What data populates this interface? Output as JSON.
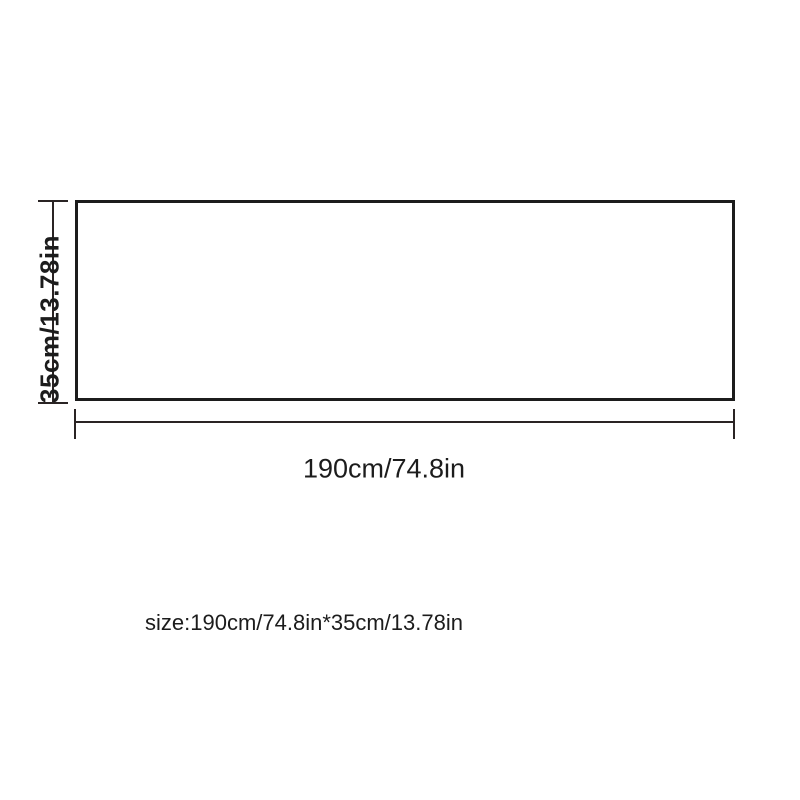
{
  "diagram": {
    "height_label": "35cm/13.78in",
    "width_label": "190cm/74.8in",
    "size_caption": "size:190cm/74.8in*35cm/13.78in",
    "dimensions": {
      "width_cm": 190,
      "width_in": 74.8,
      "height_cm": 35,
      "height_in": 13.78
    },
    "colors": {
      "background": "#ffffff",
      "outline": "#1c1c1c",
      "dimension_line": "#2a2424",
      "text": "#1c1c1c"
    }
  }
}
